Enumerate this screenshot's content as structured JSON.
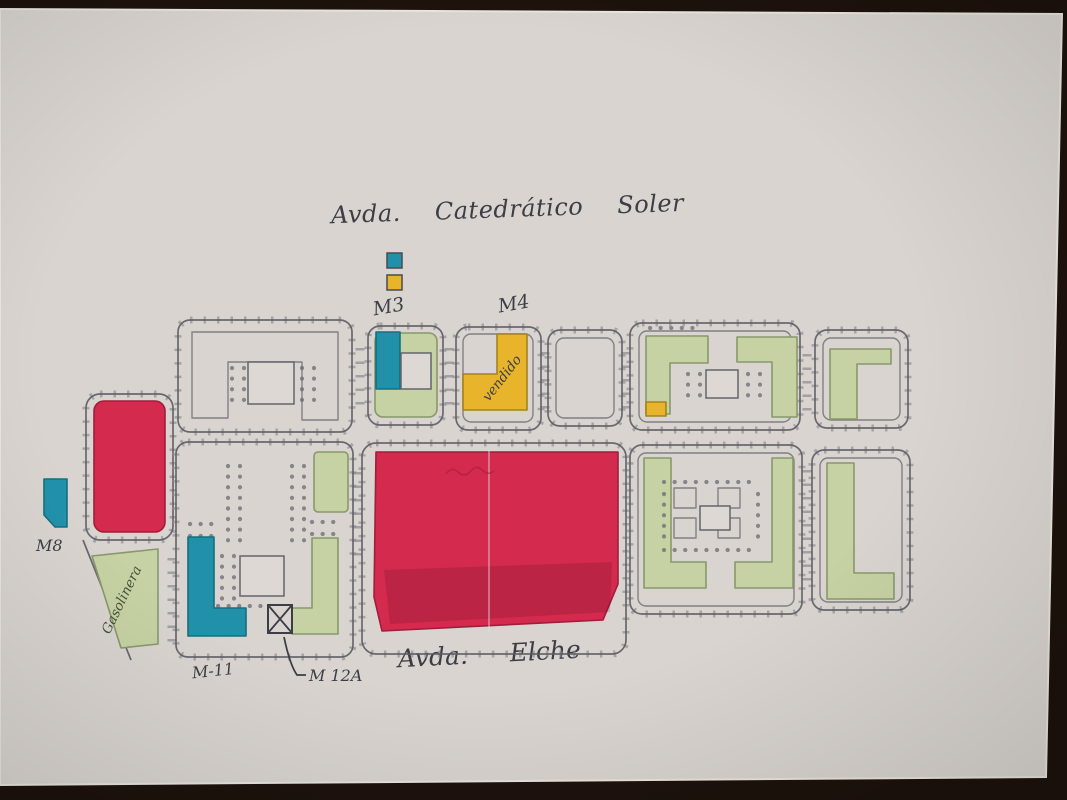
{
  "photo": {
    "backdrop_color": "#1d120c",
    "paper_color": "#d9d4cf"
  },
  "streets": {
    "top": "Avda. Catedrático Soler",
    "bottom": "Avda. Elche"
  },
  "block_labels": {
    "m3": "M3",
    "m4": "M4",
    "m8": "M8",
    "m11": "M-11",
    "m12a": "M 12A"
  },
  "annotations": {
    "sold_note": "vendido",
    "gas_station": "Gasolinera"
  },
  "legend": {
    "swatches": [
      {
        "name": "teal",
        "color": "#2191aa"
      },
      {
        "name": "yellow",
        "color": "#e8b42c"
      }
    ]
  },
  "colors": {
    "red": "#d32a4e",
    "teal": "#2191aa",
    "yellow": "#e8b42c",
    "green": "#c6d2a3",
    "ink": "#3d3d46"
  }
}
